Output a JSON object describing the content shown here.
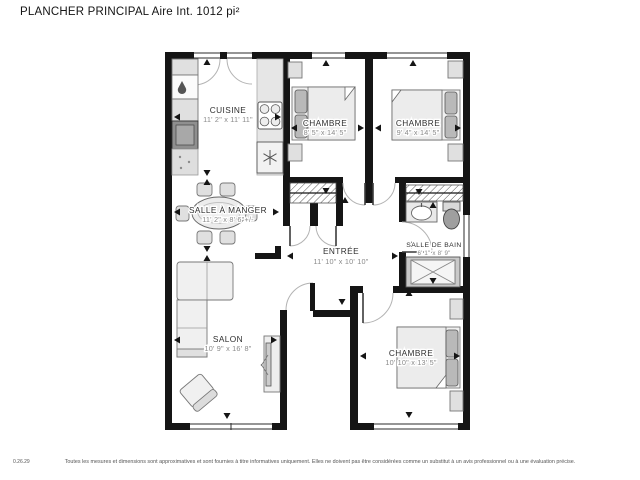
{
  "title": "PLANCHER PRINCIPAL Aire Int. 1012 pi²",
  "rooms": {
    "cuisine": {
      "name": "CUISINE",
      "dims": "11' 2\" x 11' 11\""
    },
    "chambre1": {
      "name": "CHAMBRE",
      "dims": "8' 5\" x 14' 5\""
    },
    "chambre2": {
      "name": "CHAMBRE",
      "dims": "9' 4\" x 14' 5\""
    },
    "salle_a_manger": {
      "name": "SALLE À MANGER",
      "dims": "11' 2\" x 8' 6\"+/-"
    },
    "entree": {
      "name": "ENTRÉE",
      "dims": "11' 10\" x 10' 10\""
    },
    "salle_de_bain": {
      "name": "SALLE DE BAIN",
      "dims": "6' 1\" x 8' 9\""
    },
    "salon": {
      "name": "SALON",
      "dims": "10' 9\" x 16' 8\""
    },
    "chambre3": {
      "name": "CHAMBRE",
      "dims": "10' 10\" x 13' 5\""
    }
  },
  "footer": {
    "version": "0.26.29",
    "disclaimer": "Toutes les mesures et dimensions sont approximatives et sont fournies à titre informatives uniquement. Elles ne doivent pas être considérées comme un substitut à un avis professionnel ou à une évaluation précise."
  },
  "colors": {
    "wall": "#151515",
    "label": "#2f2f2f",
    "dims_text": "#8a8a8a",
    "background": "#ffffff"
  }
}
